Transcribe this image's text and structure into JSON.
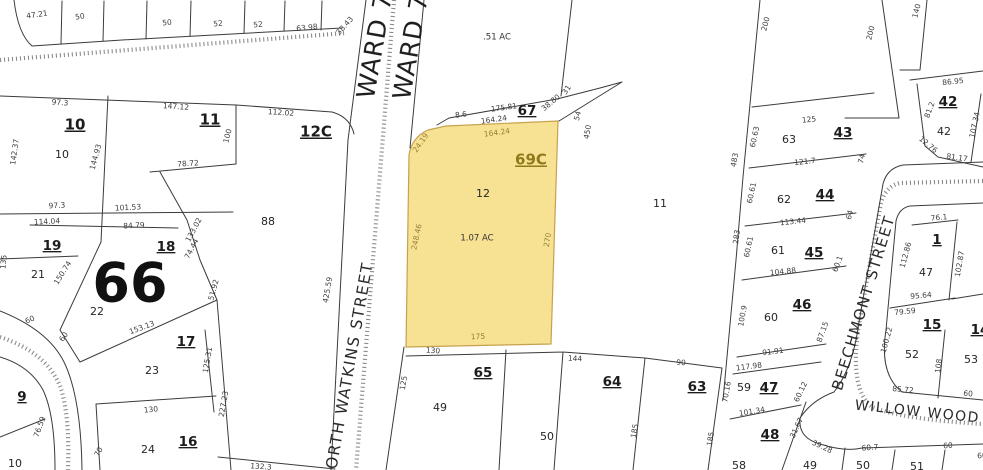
{
  "map": {
    "description_colors": {
      "highlight_fill": "#f7e193",
      "highlight_stroke": "#c7a14e",
      "highlight_text": "#8f7a1c",
      "boundary": "#3b3b3b",
      "hatch": "#8b8b8b"
    },
    "labels": [
      {
        "k": "ward",
        "t": "WARD 7",
        "x": 376,
        "y": 46,
        "r": -80,
        "s": 25
      },
      {
        "k": "ward",
        "t": "WARD 7",
        "x": 412,
        "y": 47,
        "r": -80,
        "s": 25
      },
      {
        "k": "street",
        "t": "NORTH WATKINS STREET",
        "x": 349,
        "y": 372,
        "r": -80,
        "s": 15.5
      },
      {
        "k": "street",
        "t": "BEECHMONT STREET",
        "x": 864,
        "y": 303,
        "r": -73,
        "s": 15
      },
      {
        "k": "street",
        "t": "WILLOW WOOD AVE",
        "x": 936,
        "y": 414,
        "r": 6,
        "s": 14
      },
      {
        "k": "block",
        "t": "10",
        "x": 75,
        "y": 125,
        "u": 1
      },
      {
        "k": "block",
        "t": "11",
        "x": 210,
        "y": 120,
        "u": 1
      },
      {
        "k": "block",
        "t": "12C",
        "x": 316,
        "y": 132,
        "u": 1
      },
      {
        "k": "block",
        "t": "19",
        "x": 52,
        "y": 246,
        "u": 1,
        "s": 13.5
      },
      {
        "k": "block",
        "t": "18",
        "x": 166,
        "y": 247,
        "u": 1,
        "s": 13.5
      },
      {
        "k": "big",
        "t": "66",
        "x": 130,
        "y": 287,
        "s": 54
      },
      {
        "k": "block",
        "t": "17",
        "x": 186,
        "y": 342,
        "u": 1,
        "s": 13.5
      },
      {
        "k": "block",
        "t": "16",
        "x": 188,
        "y": 442,
        "u": 1,
        "s": 13.5
      },
      {
        "k": "block",
        "t": "9",
        "x": 22,
        "y": 397,
        "u": 1,
        "s": 13.5
      },
      {
        "k": "block",
        "t": "69C",
        "x": 531,
        "y": 160,
        "u": 1,
        "s": 15,
        "c": "hl"
      },
      {
        "k": "block",
        "t": "67",
        "x": 527,
        "y": 111,
        "u": 1,
        "s": 13.5
      },
      {
        "k": "block",
        "t": "65",
        "x": 483,
        "y": 373,
        "u": 1,
        "s": 13.5
      },
      {
        "k": "block",
        "t": "64",
        "x": 612,
        "y": 382,
        "u": 1,
        "s": 13.5
      },
      {
        "k": "block",
        "t": "63",
        "x": 697,
        "y": 387,
        "u": 1,
        "s": 13.5
      },
      {
        "k": "block",
        "t": "43",
        "x": 843,
        "y": 133,
        "u": 1,
        "s": 13.5
      },
      {
        "k": "block",
        "t": "44",
        "x": 825,
        "y": 195,
        "u": 1,
        "s": 13.5
      },
      {
        "k": "block",
        "t": "45",
        "x": 814,
        "y": 253,
        "u": 1,
        "s": 13.5
      },
      {
        "k": "block",
        "t": "46",
        "x": 802,
        "y": 305,
        "u": 1,
        "s": 13.5
      },
      {
        "k": "block",
        "t": "47",
        "x": 769,
        "y": 388,
        "u": 1,
        "s": 13.5
      },
      {
        "k": "block",
        "t": "48",
        "x": 770,
        "y": 435,
        "u": 1,
        "s": 13.5
      },
      {
        "k": "block",
        "t": "42",
        "x": 948,
        "y": 102,
        "u": 1,
        "s": 13.5
      },
      {
        "k": "block",
        "t": "1",
        "x": 937,
        "y": 240,
        "u": 1,
        "s": 13.5
      },
      {
        "k": "block",
        "t": "15",
        "x": 932,
        "y": 325,
        "u": 1,
        "s": 13.5
      },
      {
        "k": "block",
        "t": "14",
        "x": 980,
        "y": 330,
        "u": 1,
        "s": 13.5
      },
      {
        "k": "num",
        "t": "10",
        "x": 62,
        "y": 155
      },
      {
        "k": "num",
        "t": "88",
        "x": 268,
        "y": 222
      },
      {
        "k": "num",
        "t": "21",
        "x": 38,
        "y": 275
      },
      {
        "k": "num",
        "t": "22",
        "x": 97,
        "y": 312
      },
      {
        "k": "num",
        "t": "23",
        "x": 152,
        "y": 371
      },
      {
        "k": "num",
        "t": "24",
        "x": 148,
        "y": 450
      },
      {
        "k": "num",
        "t": "10",
        "x": 15,
        "y": 464
      },
      {
        "k": "num",
        "t": "12",
        "x": 483,
        "y": 194
      },
      {
        "k": "num",
        "t": "11",
        "x": 660,
        "y": 204
      },
      {
        "k": "num",
        "t": "49",
        "x": 440,
        "y": 408
      },
      {
        "k": "num",
        "t": "50",
        "x": 547,
        "y": 437
      },
      {
        "k": "num",
        "t": "63",
        "x": 789,
        "y": 140
      },
      {
        "k": "num",
        "t": "62",
        "x": 784,
        "y": 200
      },
      {
        "k": "num",
        "t": "61",
        "x": 778,
        "y": 251
      },
      {
        "k": "num",
        "t": "60",
        "x": 771,
        "y": 318
      },
      {
        "k": "num",
        "t": "59",
        "x": 744,
        "y": 388
      },
      {
        "k": "num",
        "t": "58",
        "x": 739,
        "y": 466
      },
      {
        "k": "num",
        "t": "42",
        "x": 944,
        "y": 132
      },
      {
        "k": "num",
        "t": "47",
        "x": 926,
        "y": 273
      },
      {
        "k": "num",
        "t": "52",
        "x": 912,
        "y": 355
      },
      {
        "k": "num",
        "t": "53",
        "x": 971,
        "y": 360
      },
      {
        "k": "num",
        "t": "49",
        "x": 810,
        "y": 466
      },
      {
        "k": "num",
        "t": "50",
        "x": 863,
        "y": 466
      },
      {
        "k": "num",
        "t": "51",
        "x": 917,
        "y": 467
      },
      {
        "k": "area",
        "t": ".51 AC",
        "x": 497,
        "y": 37
      },
      {
        "k": "area",
        "t": "1.07 AC",
        "x": 477,
        "y": 238
      },
      {
        "k": "dim",
        "t": "47.21",
        "x": 37,
        "y": 15,
        "r": -8
      },
      {
        "k": "dim",
        "t": "50",
        "x": 80,
        "y": 17,
        "r": -8
      },
      {
        "k": "dim",
        "t": "50",
        "x": 167,
        "y": 23,
        "r": -6
      },
      {
        "k": "dim",
        "t": "52",
        "x": 218,
        "y": 24,
        "r": -6
      },
      {
        "k": "dim",
        "t": "52",
        "x": 258,
        "y": 25,
        "r": -6
      },
      {
        "k": "dim",
        "t": "63.98",
        "x": 307,
        "y": 28,
        "r": -6
      },
      {
        "k": "dim",
        "t": "38.43",
        "x": 345,
        "y": 26,
        "r": -48
      },
      {
        "k": "dim",
        "t": "97.3",
        "x": 60,
        "y": 103,
        "r": 4
      },
      {
        "k": "dim",
        "t": "147.12",
        "x": 176,
        "y": 107,
        "r": 4
      },
      {
        "k": "dim",
        "t": "112.02",
        "x": 281,
        "y": 113,
        "r": 4
      },
      {
        "k": "dim",
        "t": "142.37",
        "x": 15,
        "y": 152,
        "r": -82
      },
      {
        "k": "dim",
        "t": "144.93",
        "x": 96,
        "y": 157,
        "r": -75
      },
      {
        "k": "dim",
        "t": "100",
        "x": 228,
        "y": 136,
        "r": -75
      },
      {
        "k": "dim",
        "t": "78.72",
        "x": 188,
        "y": 164,
        "r": -4
      },
      {
        "k": "dim",
        "t": "97.3",
        "x": 57,
        "y": 206,
        "r": -3
      },
      {
        "k": "dim",
        "t": "101.53",
        "x": 128,
        "y": 208,
        "r": -3
      },
      {
        "k": "dim",
        "t": "114.04",
        "x": 47,
        "y": 222,
        "r": -3
      },
      {
        "k": "dim",
        "t": "84.79",
        "x": 134,
        "y": 226,
        "r": -3
      },
      {
        "k": "dim",
        "t": "133.02",
        "x": 194,
        "y": 230,
        "r": -62
      },
      {
        "k": "dim",
        "t": "74.44",
        "x": 192,
        "y": 249,
        "r": -62
      },
      {
        "k": "dim",
        "t": "135",
        "x": 4,
        "y": 262,
        "r": -85
      },
      {
        "k": "dim",
        "t": "150.74",
        "x": 63,
        "y": 273,
        "r": -58
      },
      {
        "k": "dim",
        "t": "51.92",
        "x": 214,
        "y": 290,
        "r": -75
      },
      {
        "k": "dim",
        "t": "60",
        "x": 30,
        "y": 320,
        "r": -25
      },
      {
        "k": "dim",
        "t": "60",
        "x": 64,
        "y": 337,
        "r": -55
      },
      {
        "k": "dim",
        "t": "153.13",
        "x": 142,
        "y": 328,
        "r": -20
      },
      {
        "k": "dim",
        "t": "125.31",
        "x": 208,
        "y": 360,
        "r": -80
      },
      {
        "k": "dim",
        "t": "227.23",
        "x": 224,
        "y": 404,
        "r": -80
      },
      {
        "k": "dim",
        "t": "130",
        "x": 151,
        "y": 410,
        "r": -5
      },
      {
        "k": "dim",
        "t": "76.59",
        "x": 40,
        "y": 427,
        "r": -70
      },
      {
        "k": "dim",
        "t": "70",
        "x": 99,
        "y": 452,
        "r": -62
      },
      {
        "k": "dim",
        "t": "132.3",
        "x": 261,
        "y": 467,
        "r": 4
      },
      {
        "k": "dim",
        "t": "425.59",
        "x": 328,
        "y": 290,
        "r": -80
      },
      {
        "k": "dim",
        "t": "24.19",
        "x": 421,
        "y": 143,
        "r": -55,
        "c": "hd"
      },
      {
        "k": "dim",
        "t": "8.6",
        "x": 461,
        "y": 115,
        "r": -7
      },
      {
        "k": "dim",
        "t": "175.81",
        "x": 504,
        "y": 108,
        "r": -8
      },
      {
        "k": "dim",
        "t": "164.24",
        "x": 494,
        "y": 120,
        "r": -8
      },
      {
        "k": "dim",
        "t": "164.24",
        "x": 497,
        "y": 133,
        "r": -8,
        "c": "hd"
      },
      {
        "k": "dim",
        "t": "31",
        "x": 567,
        "y": 90,
        "r": -55
      },
      {
        "k": "dim",
        "t": "38.80",
        "x": 551,
        "y": 103,
        "r": -40
      },
      {
        "k": "dim",
        "t": "54",
        "x": 578,
        "y": 116,
        "r": -75
      },
      {
        "k": "dim",
        "t": "450",
        "x": 588,
        "y": 132,
        "r": -80
      },
      {
        "k": "dim",
        "t": "248.46",
        "x": 417,
        "y": 237,
        "r": -78,
        "c": "hd"
      },
      {
        "k": "dim",
        "t": "270",
        "x": 548,
        "y": 240,
        "r": -80,
        "c": "hd"
      },
      {
        "k": "dim",
        "t": "175",
        "x": 478,
        "y": 337,
        "r": -2,
        "c": "hd"
      },
      {
        "k": "dim",
        "t": "130",
        "x": 433,
        "y": 351,
        "r": 3
      },
      {
        "k": "dim",
        "t": "125",
        "x": 404,
        "y": 383,
        "r": -80
      },
      {
        "k": "dim",
        "t": "144",
        "x": 575,
        "y": 359,
        "r": 3
      },
      {
        "k": "dim",
        "t": "90",
        "x": 681,
        "y": 363,
        "r": 3
      },
      {
        "k": "dim",
        "t": "185",
        "x": 635,
        "y": 431,
        "r": -80
      },
      {
        "k": "dim",
        "t": "185",
        "x": 711,
        "y": 439,
        "r": -80
      },
      {
        "k": "dim",
        "t": "200",
        "x": 766,
        "y": 24,
        "r": -75
      },
      {
        "k": "dim",
        "t": "200",
        "x": 871,
        "y": 33,
        "r": -75
      },
      {
        "k": "dim",
        "t": "140",
        "x": 917,
        "y": 11,
        "r": -75
      },
      {
        "k": "dim",
        "t": "483",
        "x": 735,
        "y": 160,
        "r": -80
      },
      {
        "k": "dim",
        "t": "60.63",
        "x": 755,
        "y": 137,
        "r": -78
      },
      {
        "k": "dim",
        "t": "125",
        "x": 809,
        "y": 120,
        "r": -6
      },
      {
        "k": "dim",
        "t": "121.7",
        "x": 805,
        "y": 162,
        "r": -6
      },
      {
        "k": "dim",
        "t": "74",
        "x": 862,
        "y": 159,
        "r": -75
      },
      {
        "k": "dim",
        "t": "60.61",
        "x": 752,
        "y": 193,
        "r": -78
      },
      {
        "k": "dim",
        "t": "113.44",
        "x": 793,
        "y": 222,
        "r": -6
      },
      {
        "k": "dim",
        "t": "64",
        "x": 850,
        "y": 215,
        "r": -75
      },
      {
        "k": "dim",
        "t": "283",
        "x": 737,
        "y": 237,
        "r": -82
      },
      {
        "k": "dim",
        "t": "60.61",
        "x": 749,
        "y": 247,
        "r": -78
      },
      {
        "k": "dim",
        "t": "104.88",
        "x": 783,
        "y": 272,
        "r": -6
      },
      {
        "k": "dim",
        "t": "60.1",
        "x": 838,
        "y": 264,
        "r": -70
      },
      {
        "k": "dim",
        "t": "100.9",
        "x": 743,
        "y": 316,
        "r": -80
      },
      {
        "k": "dim",
        "t": "87.15",
        "x": 823,
        "y": 332,
        "r": -70
      },
      {
        "k": "dim",
        "t": "91.91",
        "x": 773,
        "y": 352,
        "r": -7
      },
      {
        "k": "dim",
        "t": "117.98",
        "x": 749,
        "y": 367,
        "r": -7
      },
      {
        "k": "dim",
        "t": "70.16",
        "x": 727,
        "y": 392,
        "r": -80
      },
      {
        "k": "dim",
        "t": "101.34",
        "x": 752,
        "y": 412,
        "r": -9
      },
      {
        "k": "dim",
        "t": "60.12",
        "x": 801,
        "y": 392,
        "r": -65
      },
      {
        "k": "dim",
        "t": "31.67",
        "x": 797,
        "y": 428,
        "r": -65
      },
      {
        "k": "dim",
        "t": "39.28",
        "x": 822,
        "y": 447,
        "r": 25
      },
      {
        "k": "dim",
        "t": "86.95",
        "x": 953,
        "y": 82,
        "r": -6
      },
      {
        "k": "dim",
        "t": "81.2",
        "x": 930,
        "y": 110,
        "r": -70
      },
      {
        "k": "dim",
        "t": "107.34",
        "x": 975,
        "y": 125,
        "r": -78
      },
      {
        "k": "dim",
        "t": "12.76",
        "x": 928,
        "y": 145,
        "r": 40
      },
      {
        "k": "dim",
        "t": "81.17",
        "x": 957,
        "y": 158,
        "r": 8
      },
      {
        "k": "dim",
        "t": "112.86",
        "x": 906,
        "y": 255,
        "r": -75
      },
      {
        "k": "dim",
        "t": "76.1",
        "x": 939,
        "y": 218,
        "r": -5
      },
      {
        "k": "dim",
        "t": "102.87",
        "x": 960,
        "y": 264,
        "r": -80
      },
      {
        "k": "dim",
        "t": "95.64",
        "x": 921,
        "y": 296,
        "r": -5
      },
      {
        "k": "dim",
        "t": "79.59",
        "x": 905,
        "y": 312,
        "r": -6
      },
      {
        "k": "dim",
        "t": "100.22",
        "x": 887,
        "y": 340,
        "r": -75
      },
      {
        "k": "dim",
        "t": "108",
        "x": 939,
        "y": 366,
        "r": -82
      },
      {
        "k": "dim",
        "t": "85.72",
        "x": 903,
        "y": 390,
        "r": 5
      },
      {
        "k": "dim",
        "t": "60",
        "x": 968,
        "y": 394,
        "r": 5
      },
      {
        "k": "dim",
        "t": "60.7",
        "x": 870,
        "y": 448,
        "r": -4
      },
      {
        "k": "dim",
        "t": "60",
        "x": 948,
        "y": 446,
        "r": -4
      },
      {
        "k": "dim",
        "t": "60",
        "x": 982,
        "y": 456,
        "r": -4
      }
    ]
  }
}
